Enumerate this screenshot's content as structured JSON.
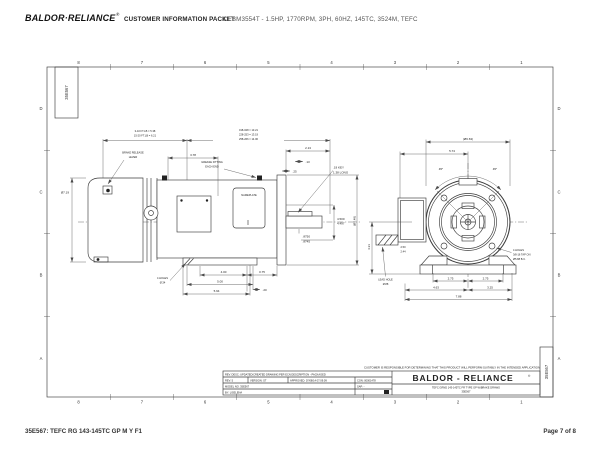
{
  "header": {
    "logo": "BALDOR·RELIANCE",
    "logo_reg": "®",
    "packet_label": "CUSTOMER INFORMATION PACKET",
    "model_line": "CEBM3554T - 1.5HP, 1770RPM, 3PH, 60HZ, 145TC, 3524M, TEFC"
  },
  "footer": {
    "left": "35E567: TEFC RG 143-145TC GP M Y F1",
    "right": "Page 7 of 8"
  },
  "drawing": {
    "number": "35E567",
    "grid_cols": [
      "8",
      "7",
      "6",
      "5",
      "4",
      "3",
      "2",
      "1"
    ],
    "grid_rows": [
      "D",
      "C",
      "B",
      "A"
    ],
    "note": "CUSTOMER IS RESPONSIBLE FOR DETERMINING THAT THIS PRODUCT WILL PERFORM SUITABLY IN THE INTENDED APPLICATION",
    "side_view": {
      "brake_dim_1": "3-10 FT.LB = 5.38",
      "brake_dim_2": "15-20 FT.LB = 6.21",
      "len_dim_1": "018-028 = 13.21",
      "len_dim_2": "228-253 = 13.19",
      "len_dim_3": "258-266 = 14.06",
      "brake_release_1": "BRAKE RELEASE",
      "brake_release_2": "LEVER",
      "dim_378": "3.78",
      "grease_1": "GREASE FITTING",
      "grease_2": "EACH END",
      "nameplate": "NAMEPLATE",
      "dim_213": "2.13",
      "dim_13": ".13",
      "dim_25": ".25",
      "key_1": ".19 KEY",
      "key_2": "1.38 LONG",
      "dia_719": "Ø7.19",
      "ak_1": "4.500",
      "ak_2": "4.497",
      "shaft_1": ".8750",
      "shaft_2": ".8745",
      "flange_dia": "(Ø6.48)",
      "holes_1": "4 HOLES",
      "holes_2": "Ø.34",
      "base_dim_1": "4.00",
      "base_dim_2": "0.75",
      "base_dim_3": "5.00",
      "base_dim_4": ".20",
      "base_dim_5": "5.94"
    },
    "end_view": {
      "od_dim": "(Ø6.63)",
      "dim_574": "5.74",
      "angle_left": "45°",
      "angle_right": "45°",
      "tap_1": "4 HOLES",
      "tap_2": "3/8-16 TAP ON",
      "tap_3": "Ø5.88 B.C.",
      "lead_1": "LEAD HOLE",
      "lead_2": "Ø.88",
      "dim_250": "2.50",
      "dim_244": "2.44",
      "height_dim": "4.31",
      "e_dim_left": "2.75",
      "e_dim_right": "2.75",
      "dim_463": "4.63",
      "dim_325": "3.25",
      "dim_788": "7.88"
    },
    "title_block": {
      "rev_desc": "REV. DESC: UPDATED/CREATED DRAWING PER ECN DESCRIPTION - PACKAGED",
      "rev": "REV: 5",
      "version": "VERSION: ST",
      "approved": "APPROVED: 07/08/14 07:09:09",
      "con": "CON: 00001478",
      "model_no": "MODEL NO. 35E567",
      "sap": "SAP: -",
      "by": "BY: LISELENA",
      "brand": "BALDOR - RELIANCE",
      "brand_reg": "®",
      "title_1": "TEFC GRND 143-145TC FR TYPE GP W/BRAKE DRAWG",
      "title_2": "35E567"
    }
  }
}
